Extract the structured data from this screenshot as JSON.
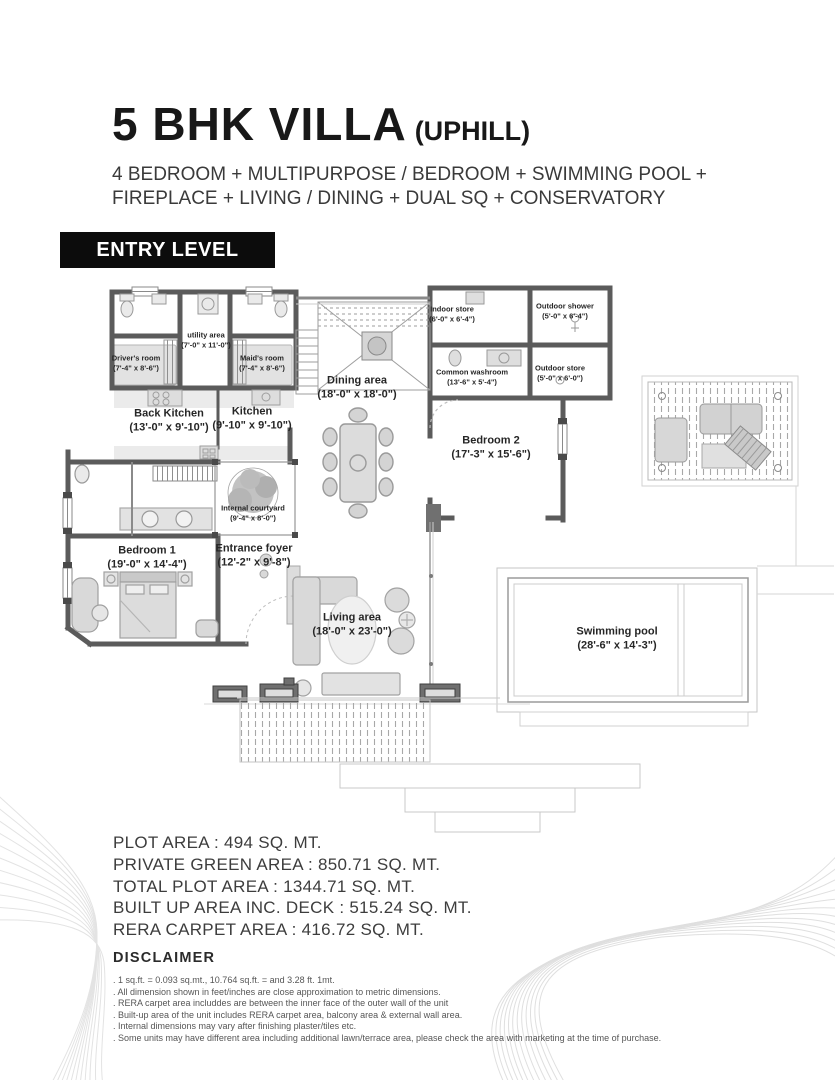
{
  "header": {
    "title": "5 BHK VILLA",
    "title_suffix": "(UPHILL)",
    "subtitle_line1": "4 BEDROOM + MULTIPURPOSE / BEDROOM + SWIMMING POOL +",
    "subtitle_line2": "FIREPLACE + LIVING / DINING + DUAL SQ + CONSERVATORY",
    "level_label": "ENTRY LEVEL"
  },
  "plan": {
    "rooms": [
      {
        "name": "Driver's room",
        "dims": "(7'-4\" x 8'-6\")"
      },
      {
        "name": "utility area",
        "dims": "(7'-0\" x 11'-0\")"
      },
      {
        "name": "Maid's room",
        "dims": "(7'-4\" x 8'-6\")"
      },
      {
        "name": "Back Kitchen",
        "dims": "(13'-0\" x 9'-10\")"
      },
      {
        "name": "Kitchen",
        "dims": "(9'-10\" x 9'-10\")"
      },
      {
        "name": "Dining area",
        "dims": "(18'-0\" x 18'-0\")"
      },
      {
        "name": "Indoor store",
        "dims": "(6'-0\" x 6'-4\")"
      },
      {
        "name": "Outdoor shower",
        "dims": "(5'-0\" x 6'-4\")"
      },
      {
        "name": "Common washroom",
        "dims": "(13'-6\" x 5'-4\")"
      },
      {
        "name": "Outdoor store",
        "dims": "(5'-0\" x 6'-0\")"
      },
      {
        "name": "Bedroom 2",
        "dims": "(17'-3\" x 15'-6\")"
      },
      {
        "name": "Internal courtyard",
        "dims": "(9'-4\" x 8'-0\")"
      },
      {
        "name": "Bedroom 1",
        "dims": "(19'-0\" x 14'-4\")"
      },
      {
        "name": "Entrance foyer",
        "dims": "(12'-2\" x 9'-8\")"
      },
      {
        "name": "Living area",
        "dims": "(18'-0\" x 23'-0\")"
      },
      {
        "name": "Swimming pool",
        "dims": "(28'-6\" x 14'-3\")"
      }
    ]
  },
  "areas": {
    "lines": [
      "PLOT AREA : 494 SQ. MT.",
      "PRIVATE GREEN AREA : 850.71 SQ. MT.",
      "TOTAL PLOT AREA : 1344.71 SQ. MT.",
      "BUILT UP AREA INC. DECK : 515.24 SQ. MT.",
      "RERA CARPET AREA : 416.72 SQ. MT."
    ]
  },
  "disclaimer": {
    "title": "DISCLAIMER",
    "lines": [
      ". 1 sq.ft. = 0.093 sq.mt., 10.764 sq.ft. = and 3.28 ft. 1mt.",
      ". All dimension shown in feet/inches are close approximation to metric dimensions.",
      ". RERA carpet area includdes are between the inner face of the outer wall of the unit",
      ". Built-up area of the unit includes RERA carpet area, balcony area & external wall area.",
      ". Internal dimensions may vary after finishing plaster/tiles etc.",
      ". Some units may have different area including additional lawn/terrace area, please check the area with marketing at the time of purchase."
    ]
  },
  "colors": {
    "banner_bg": "#0c0c0c",
    "banner_text": "#ffffff",
    "wall": "#5b5b5b",
    "furniture_fill": "#dcdcdc",
    "light_line": "#c4c4c4",
    "text_dark": "#181818",
    "text_muted": "#565656",
    "decor_line": "#e0e0e0"
  }
}
